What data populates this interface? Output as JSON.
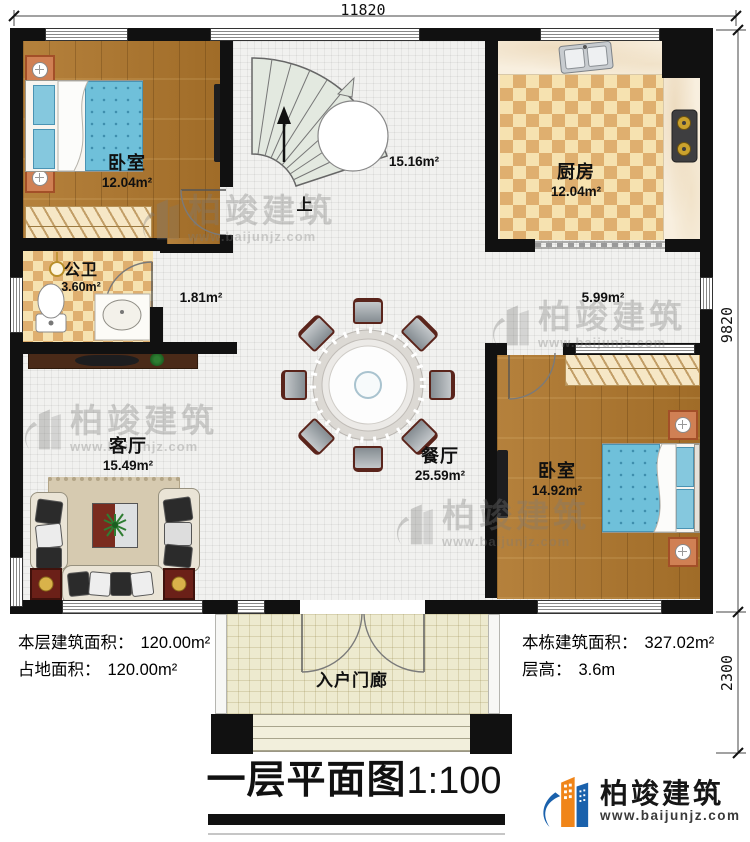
{
  "title": {
    "cn": "一层平面图",
    "scale": "1:100"
  },
  "dimensions": {
    "top": "11820",
    "right_upper": "9820",
    "right_lower": "2300"
  },
  "rooms": [
    {
      "name": "卧室",
      "area": "12.04m²"
    },
    {
      "name": "厨房",
      "area": "12.04m²"
    },
    {
      "name": "公卫",
      "area": "3.60m²"
    },
    {
      "name": "客厅",
      "area": "15.49m²"
    },
    {
      "name": "餐厅",
      "area": "25.59m²"
    },
    {
      "name": "卧室",
      "area": "14.92m²"
    },
    {
      "name": "入户门廊"
    }
  ],
  "open_areas": {
    "hall": "15.16m²",
    "nook": "1.81m²",
    "corridor": "5.99m²"
  },
  "stairs": {
    "label": "上"
  },
  "info": {
    "floor_area_label": "本层建筑面积：",
    "floor_area_value": "120.00m²",
    "footprint_label": "占地面积：",
    "footprint_value": "120.00m²",
    "total_area_label": "本栋建筑面积：",
    "total_area_value": "327.02m²",
    "height_label": "层高：",
    "height_value": "3.6m"
  },
  "brand": {
    "name": "柏竣建筑",
    "url": "www.baijunjz.com"
  },
  "watermark": {
    "name": "柏竣建筑",
    "url": "www.baijunjz.com"
  }
}
